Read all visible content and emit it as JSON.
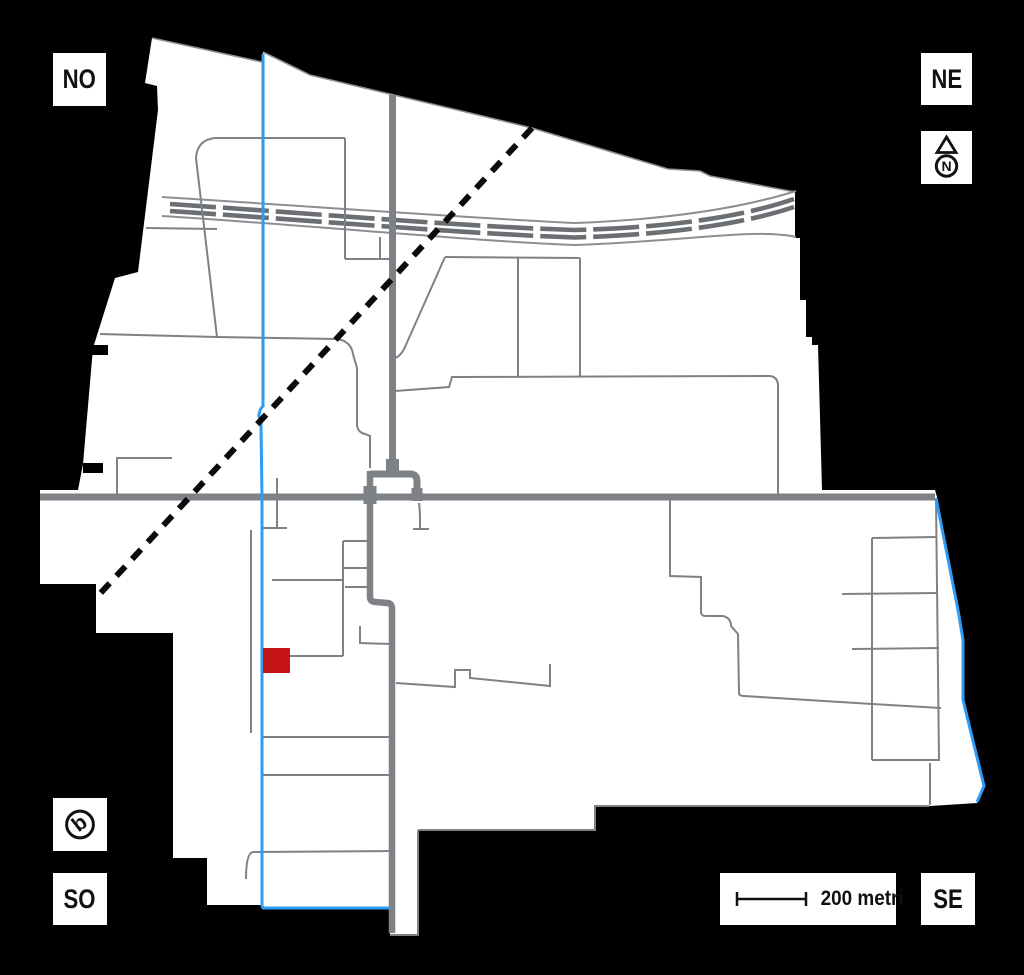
{
  "corner_labels": {
    "nw": "NO",
    "ne": "NE",
    "sw": "SO",
    "se": "SE"
  },
  "compass": {
    "letter": "N",
    "icon": "north-arrow-icon"
  },
  "logo": {
    "letter": "b",
    "icon": "logo-b-icon"
  },
  "scale_bar": {
    "label": "200 metri"
  },
  "colors": {
    "background": "#000000",
    "map_fill": "#ffffff",
    "road_gray": "#7e8286",
    "street_gray": "#7e8286",
    "railway_dark": "#6b6f73",
    "railway_light": "#8b8e92",
    "canal_blue": "#2e9cf4",
    "marker_red": "#c61518",
    "dashed_line_black": "#0b0b0b"
  }
}
